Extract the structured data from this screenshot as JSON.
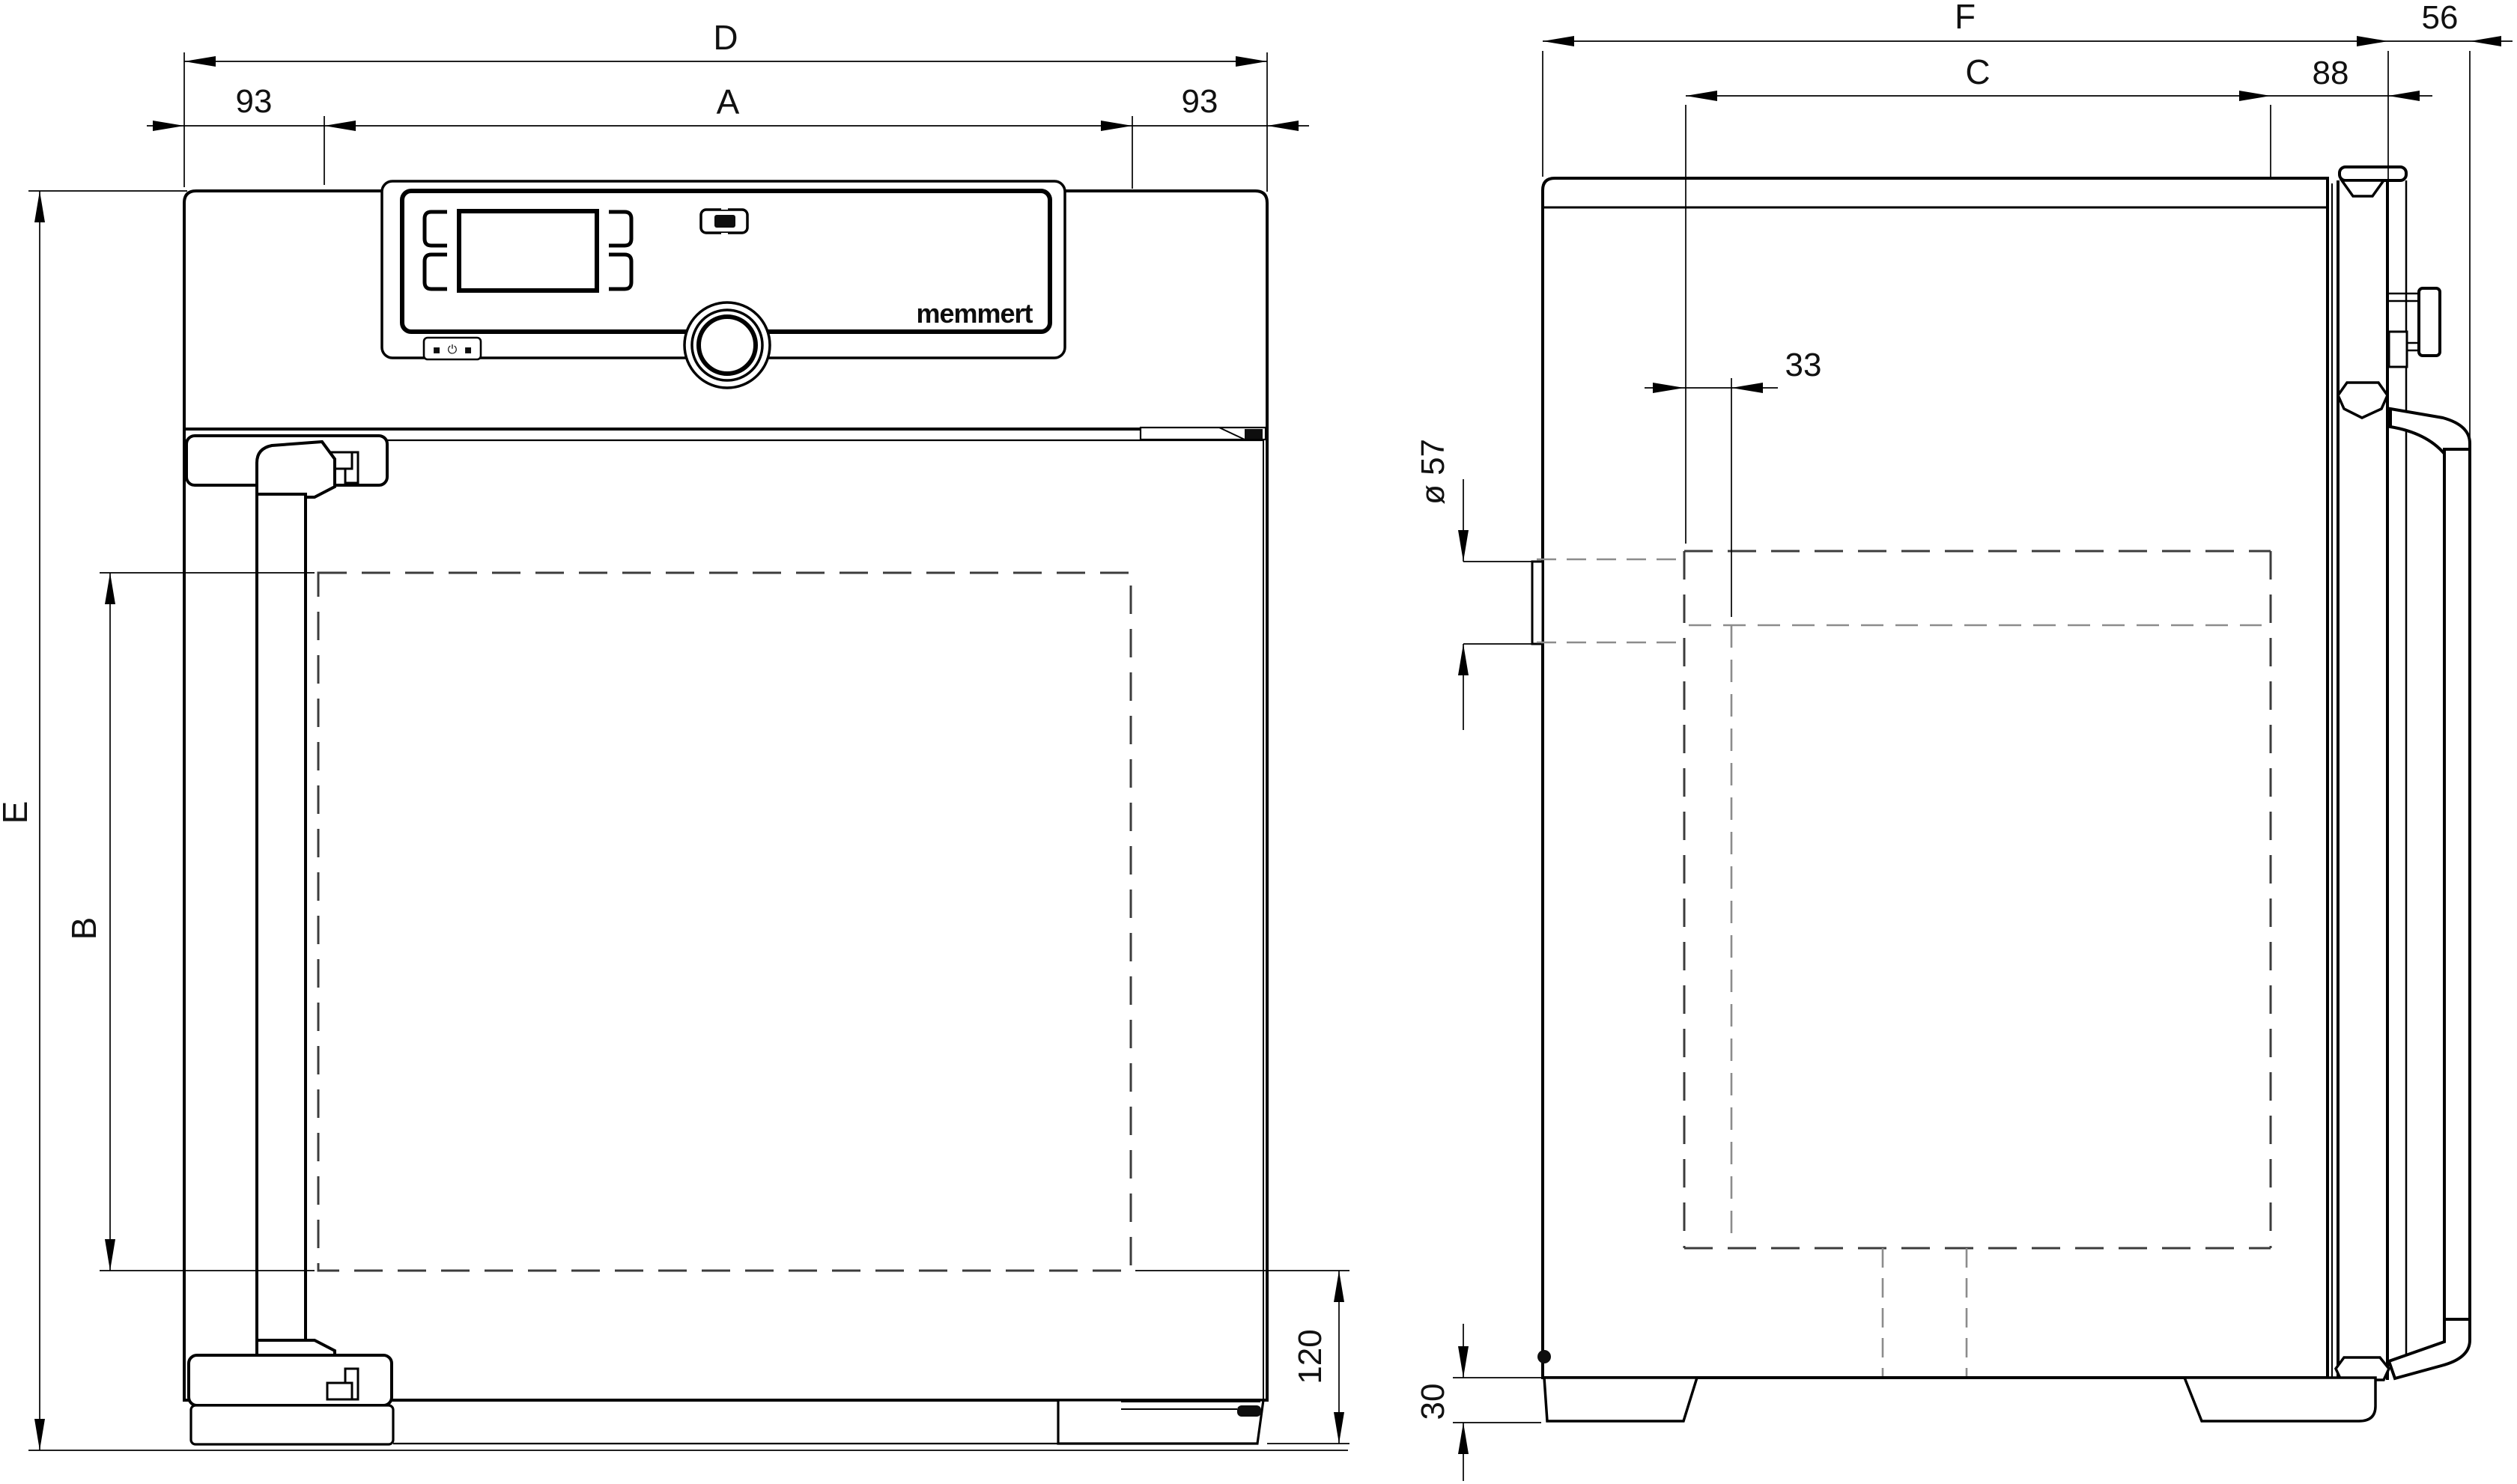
{
  "page": {
    "background": "#ffffff",
    "line_color": "#000000",
    "dashed_dark_color": "#3c3c3c",
    "dashed_gray_color": "#8c8c8c"
  },
  "front_view": {
    "dims": {
      "overall_width": "D",
      "inner_width": "A",
      "offset_left": "93",
      "offset_right": "93",
      "overall_height": "E",
      "inner_height": "B",
      "base_height": "120"
    },
    "panel": {
      "logo": "memmert",
      "indicators": [
        "▪",
        "⏻",
        "▪"
      ]
    }
  },
  "side_view": {
    "dims": {
      "overall_depth": "F",
      "inner_depth": "C",
      "door_depth": "88",
      "handle_depth": "56",
      "vent_offset": "33",
      "vent_diameter": "ø 57",
      "foot_height": "30"
    }
  }
}
